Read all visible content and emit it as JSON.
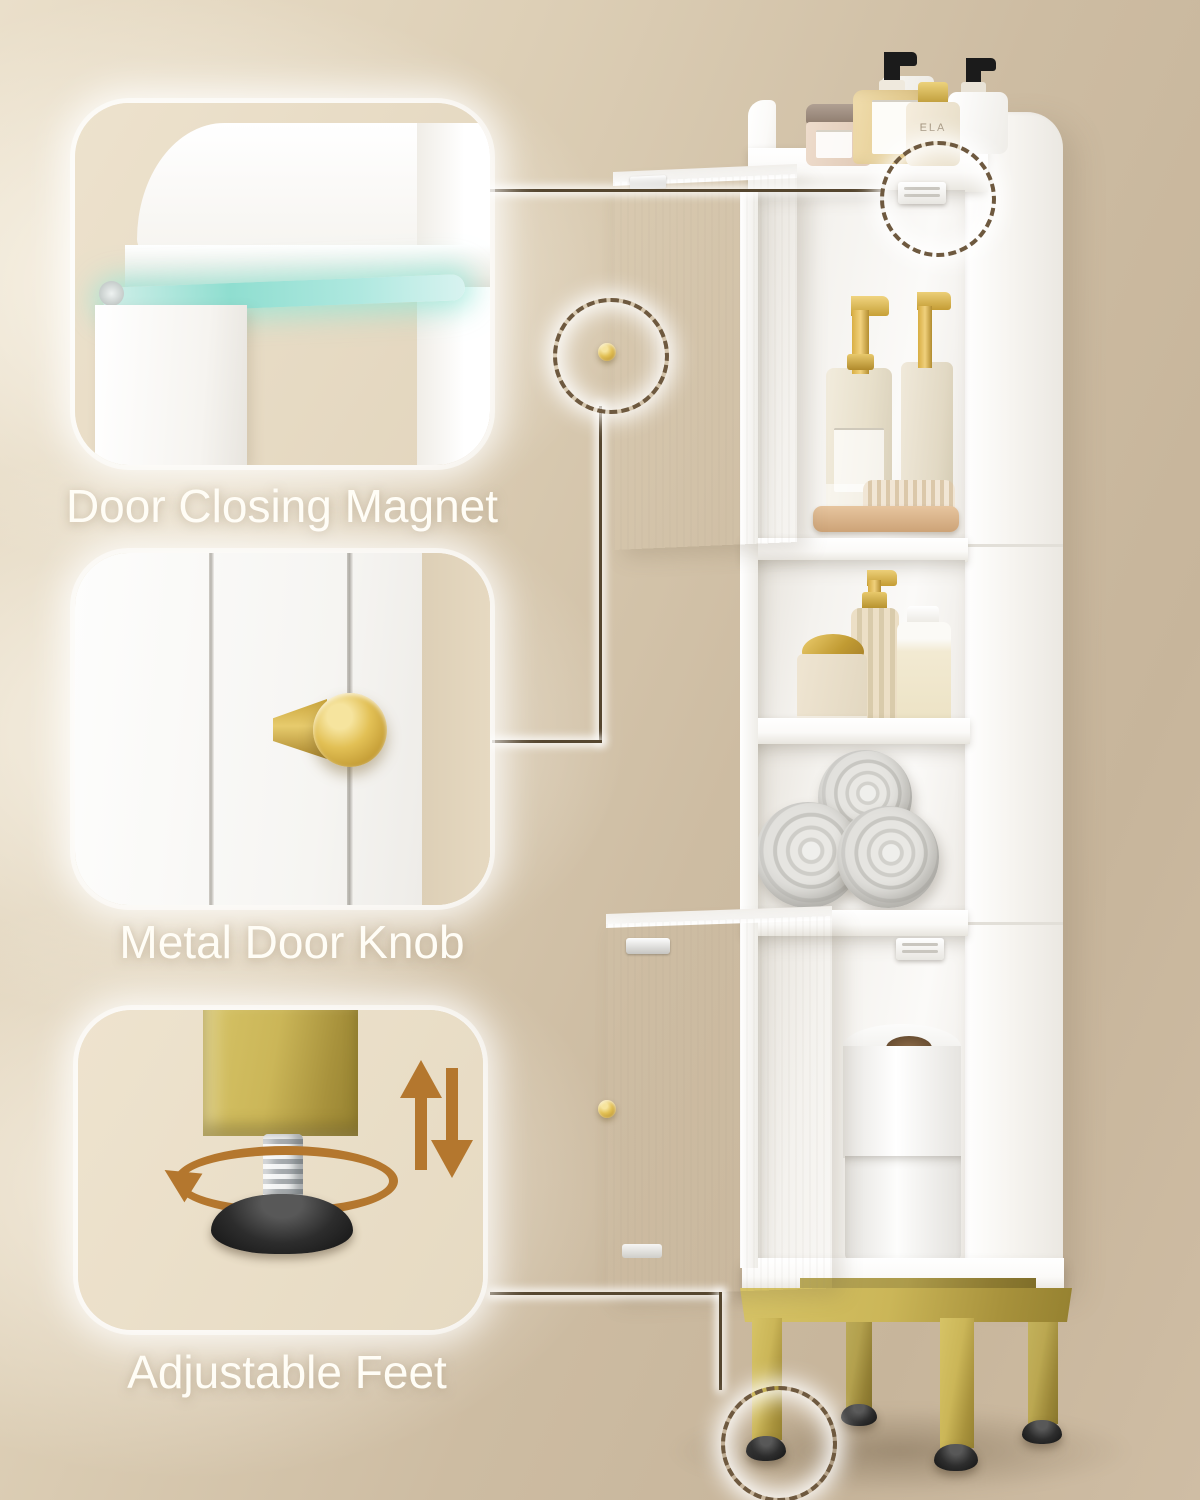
{
  "callouts": [
    {
      "id": "door-closing-magnet",
      "label": "Door Closing Magnet"
    },
    {
      "id": "metal-door-knob",
      "label": "Metal Door Knob"
    },
    {
      "id": "adjustable-feet",
      "label": "Adjustable Feet"
    }
  ],
  "product": {
    "perfume_bottle_text": "ELA"
  },
  "colors": {
    "background_beige": "#d5c5ad",
    "cabinet_white": "#ffffff",
    "gold_accent": "#c8a73f",
    "magnet_glow_teal": "#8fded0",
    "arrow_brown": "#b4772e",
    "dashed_ring_brown": "#6e593f",
    "label_text": "#fffdf6"
  }
}
